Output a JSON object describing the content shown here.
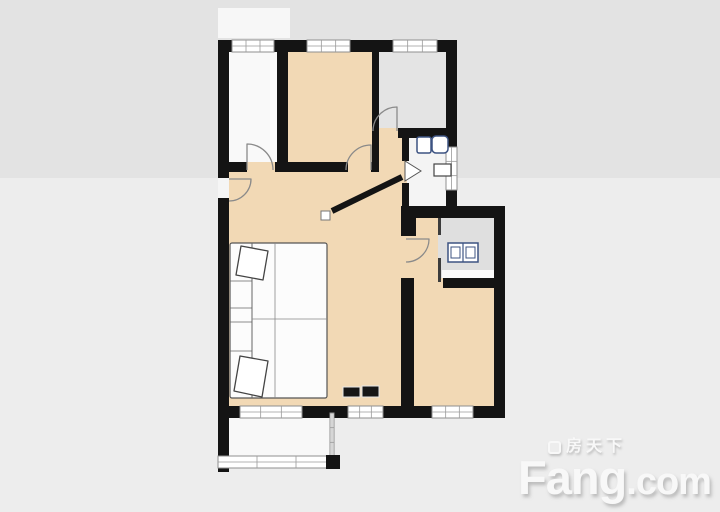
{
  "canvas": {
    "width": 720,
    "height": 512
  },
  "palette": {
    "wall": "#141414",
    "room_warm": "#f2d9b5",
    "room_gray": "#e2e2e2",
    "room_white": "#f8f8f8",
    "window_frame": "#8f8f8f",
    "fixture_outline": "#3d5382",
    "background_upper": "#e3e3e3",
    "background_lower": "#ededed",
    "logo_color": "#f8f8f8"
  },
  "logo": {
    "brand_cn": "房天下",
    "brand_en_main": "Fang",
    "brand_en_suffix": ".com"
  },
  "floorplan": {
    "shapes": [
      {
        "name": "background-upper",
        "kind": "rect",
        "x": 0,
        "y": 0,
        "w": 720,
        "h": 178,
        "fill": "#e3e3e3"
      },
      {
        "name": "background-lower",
        "kind": "rect",
        "x": 0,
        "y": 178,
        "w": 720,
        "h": 334,
        "fill": "#ededed"
      },
      {
        "name": "background-highlight-patch",
        "kind": "rect",
        "x": 218,
        "y": 8,
        "w": 72,
        "h": 30,
        "fill": "#f7f7f7"
      },
      {
        "name": "room-bedroom-left",
        "kind": "rect",
        "x": 222,
        "y": 44,
        "w": 62,
        "h": 126,
        "fill": "#f9f9f9"
      },
      {
        "name": "room-bedroom-middle",
        "kind": "rect",
        "x": 282,
        "y": 44,
        "w": 96,
        "h": 126,
        "fill": "#f2d9b5"
      },
      {
        "name": "room-bedroom-right",
        "kind": "rect",
        "x": 376,
        "y": 44,
        "w": 76,
        "h": 90,
        "fill": "#e4e4e4"
      },
      {
        "name": "room-bathroom",
        "kind": "rect",
        "x": 405,
        "y": 134,
        "w": 45,
        "h": 78,
        "fill": "#f4f4f4"
      },
      {
        "name": "hall-upper",
        "kind": "rect",
        "x": 377,
        "y": 137,
        "w": 30,
        "h": 70,
        "fill": "#f2d9b5"
      },
      {
        "name": "room-living",
        "kind": "rect",
        "x": 222,
        "y": 166,
        "w": 184,
        "h": 246,
        "fill": "#f2d9b5"
      },
      {
        "name": "hall-lower",
        "kind": "rect",
        "x": 402,
        "y": 212,
        "w": 38,
        "h": 72,
        "fill": "#f2d9b5"
      },
      {
        "name": "room-kitchen",
        "kind": "rect",
        "x": 438,
        "y": 212,
        "w": 58,
        "h": 72,
        "fill": "#dfdfdf"
      },
      {
        "name": "kitchen-counter",
        "kind": "rect",
        "x": 442,
        "y": 270,
        "w": 52,
        "h": 11,
        "fill": "#fafafa"
      },
      {
        "name": "room-bedroom-bottom",
        "kind": "rect",
        "x": 406,
        "y": 284,
        "w": 92,
        "h": 128,
        "fill": "#f2d9b5"
      },
      {
        "name": "room-balcony",
        "kind": "rect",
        "x": 222,
        "y": 412,
        "w": 112,
        "h": 52,
        "fill": "#f8f8f8"
      },
      {
        "name": "doorway-left-bedroom",
        "kind": "rect",
        "x": 247,
        "y": 162,
        "w": 28,
        "h": 10,
        "fill": "#f2d9b5"
      },
      {
        "name": "doorway-middle-bedroom",
        "kind": "rect",
        "x": 348,
        "y": 162,
        "w": 23,
        "h": 10,
        "fill": "#f2d9b5"
      },
      {
        "name": "doorway-right-bedroom",
        "kind": "rect",
        "x": 379,
        "y": 128,
        "w": 19,
        "h": 10,
        "fill": "#f2d9b5"
      },
      {
        "name": "doorway-bottom-bedroom",
        "kind": "rect",
        "x": 411,
        "y": 278,
        "w": 32,
        "h": 10,
        "fill": "#f2d9b5"
      },
      {
        "name": "doorway-entrance",
        "kind": "rect",
        "x": 218,
        "y": 178,
        "w": 11,
        "h": 20,
        "fill": "#f5f5f5"
      },
      {
        "name": "wall-top",
        "kind": "rect",
        "x": 218,
        "y": 40,
        "w": 239,
        "h": 12,
        "fill": "#141414"
      },
      {
        "name": "wall-left-upper",
        "kind": "rect",
        "x": 218,
        "y": 40,
        "w": 11,
        "h": 138,
        "fill": "#141414"
      },
      {
        "name": "wall-left-lower",
        "kind": "rect",
        "x": 218,
        "y": 198,
        "w": 11,
        "h": 274,
        "fill": "#141414"
      },
      {
        "name": "wall-bottom",
        "kind": "rect",
        "x": 218,
        "y": 406,
        "w": 287,
        "h": 12,
        "fill": "#141414"
      },
      {
        "name": "wall-right-upper",
        "kind": "rect",
        "x": 446,
        "y": 40,
        "w": 11,
        "h": 172,
        "fill": "#141414"
      },
      {
        "name": "wall-mid-east",
        "kind": "rect",
        "x": 403,
        "y": 206,
        "w": 102,
        "h": 12,
        "fill": "#141414"
      },
      {
        "name": "wall-right-lower",
        "kind": "rect",
        "x": 494,
        "y": 206,
        "w": 11,
        "h": 212,
        "fill": "#141414"
      },
      {
        "name": "wall-divider-left-middle",
        "kind": "rect",
        "x": 277,
        "y": 40,
        "w": 11,
        "h": 132,
        "fill": "#141414"
      },
      {
        "name": "wall-divider-middle-right",
        "kind": "rect",
        "x": 372,
        "y": 40,
        "w": 7,
        "h": 132,
        "fill": "#141414"
      },
      {
        "name": "wall-leftroom-bottom-west",
        "kind": "rect",
        "x": 224,
        "y": 162,
        "w": 23,
        "h": 10,
        "fill": "#141414"
      },
      {
        "name": "wall-leftroom-bottom-east",
        "kind": "rect",
        "x": 275,
        "y": 162,
        "w": 13,
        "h": 10,
        "fill": "#141414"
      },
      {
        "name": "wall-midroom-bottom",
        "kind": "rect",
        "x": 288,
        "y": 162,
        "w": 60,
        "h": 10,
        "fill": "#141414"
      },
      {
        "name": "wall-midroom-bottom-stub",
        "kind": "rect",
        "x": 371,
        "y": 162,
        "w": 8,
        "h": 10,
        "fill": "#141414"
      },
      {
        "name": "wall-grayroom-bottom",
        "kind": "rect",
        "x": 398,
        "y": 128,
        "w": 59,
        "h": 10,
        "fill": "#141414"
      },
      {
        "name": "wall-bathroom-left-upper",
        "kind": "rect",
        "x": 402,
        "y": 137,
        "w": 7,
        "h": 24,
        "fill": "#141414"
      },
      {
        "name": "wall-bathroom-left-lower",
        "kind": "rect",
        "x": 402,
        "y": 183,
        "w": 7,
        "h": 25,
        "fill": "#141414"
      },
      {
        "name": "wall-bedroom-left-upper",
        "kind": "rect",
        "x": 401,
        "y": 206,
        "w": 15,
        "h": 30,
        "fill": "#141414"
      },
      {
        "name": "wall-bedroom-left-lower",
        "kind": "rect",
        "x": 401,
        "y": 278,
        "w": 13,
        "h": 140,
        "fill": "#141414"
      },
      {
        "name": "wall-bedroom-top-west",
        "kind": "rect",
        "x": 406,
        "y": 278,
        "w": 7,
        "h": 10,
        "fill": "#141414"
      },
      {
        "name": "wall-bedroom-top-east",
        "kind": "rect",
        "x": 443,
        "y": 278,
        "w": 62,
        "h": 10,
        "fill": "#141414"
      },
      {
        "name": "wall-kitchen-partition-upper",
        "kind": "rect",
        "x": 438,
        "y": 218,
        "w": 3,
        "h": 17,
        "fill": "#3c3c3c"
      },
      {
        "name": "wall-kitchen-partition-lower",
        "kind": "rect",
        "x": 438,
        "y": 258,
        "w": 3,
        "h": 24,
        "fill": "#3c3c3c"
      },
      {
        "name": "wall-diagonal",
        "kind": "line",
        "x1": 402,
        "y1": 177,
        "x2": 332,
        "y2": 211,
        "stroke": "#141414",
        "sw": 6
      },
      {
        "name": "wall-diagonal-endcap",
        "kind": "rect",
        "x": 321,
        "y": 211,
        "w": 9,
        "h": 9,
        "fill": "#ffffff",
        "stroke": "#777777",
        "sw": 1
      },
      {
        "name": "window-top-left",
        "kind": "window",
        "x": 232,
        "y": 40,
        "w": 42,
        "h": 12
      },
      {
        "name": "window-top-middle",
        "kind": "window",
        "x": 307,
        "y": 40,
        "w": 43,
        "h": 12
      },
      {
        "name": "window-top-right",
        "kind": "window",
        "x": 393,
        "y": 40,
        "w": 44,
        "h": 12
      },
      {
        "name": "window-bathroom",
        "kind": "window",
        "x": 446,
        "y": 147,
        "w": 11,
        "h": 43,
        "vertical": true
      },
      {
        "name": "window-living-left",
        "kind": "window",
        "x": 240,
        "y": 406,
        "w": 62,
        "h": 12
      },
      {
        "name": "window-living-right",
        "kind": "window",
        "x": 348,
        "y": 406,
        "w": 35,
        "h": 12
      },
      {
        "name": "window-bedroom-bottom",
        "kind": "window",
        "x": 432,
        "y": 406,
        "w": 41,
        "h": 12
      },
      {
        "name": "balcony-side-rail",
        "kind": "window",
        "x": 330,
        "y": 413,
        "w": 4,
        "h": 44,
        "vertical": true
      },
      {
        "name": "balcony-front-rail",
        "kind": "window",
        "x": 218,
        "y": 456,
        "w": 117,
        "h": 12
      },
      {
        "name": "balcony-corner-post",
        "kind": "rect",
        "x": 326,
        "y": 455,
        "w": 14,
        "h": 14,
        "fill": "#141414"
      },
      {
        "name": "door-arc-entrance",
        "kind": "path",
        "d": "M229,179 L251,179 A22,22 0 0 1 229,201",
        "stroke": "#8a8a8a",
        "sw": 1.3
      },
      {
        "name": "door-arc-left-bedroom",
        "kind": "path",
        "d": "M247,170 L247,144 A26,26 0 0 1 273,170",
        "stroke": "#8a8a8a",
        "sw": 1.3
      },
      {
        "name": "door-arc-middle-bedroom",
        "kind": "path",
        "d": "M371,170 L371,145 A25,25 0 0 0 346,170",
        "stroke": "#8a8a8a",
        "sw": 1.3
      },
      {
        "name": "door-arc-right-bedroom",
        "kind": "path",
        "d": "M397,131 L397,107 A24,24 0 0 0 373,131",
        "stroke": "#8a8a8a",
        "sw": 1.3
      },
      {
        "name": "door-arc-kitchen",
        "kind": "path",
        "d": "M406,239 L429,239 A23,23 0 0 1 406,262",
        "stroke": "#8a8a8a",
        "sw": 1.3
      },
      {
        "name": "door-marker-bathroom",
        "kind": "polygon",
        "points": "405,161 405,181 421,171",
        "fill": "#ffffff",
        "stroke": "#555555",
        "sw": 1
      },
      {
        "name": "bathroom-sink-left",
        "kind": "rect",
        "x": 417,
        "y": 137,
        "w": 14,
        "h": 16,
        "rx": 2,
        "fill": "#ffffff",
        "stroke": "#3d5382",
        "sw": 1.5
      },
      {
        "name": "bathroom-sink-right",
        "kind": "rect",
        "x": 432,
        "y": 136,
        "w": 16,
        "h": 17,
        "rx": 4,
        "fill": "#ffffff",
        "stroke": "#3d5382",
        "sw": 1.5
      },
      {
        "name": "bathroom-toilet",
        "kind": "rect",
        "x": 434,
        "y": 164,
        "w": 17,
        "h": 12,
        "fill": "#ffffff",
        "stroke": "#444444",
        "sw": 1.2
      },
      {
        "name": "kitchen-sink-body",
        "kind": "rect",
        "x": 448,
        "y": 243,
        "w": 30,
        "h": 19,
        "fill": "#ffffff",
        "stroke": "#3d5382",
        "sw": 1.5
      },
      {
        "name": "kitchen-sink-divider",
        "kind": "line",
        "x1": 463,
        "y1": 243,
        "x2": 463,
        "y2": 262,
        "stroke": "#3d5382",
        "sw": 1.2
      },
      {
        "name": "kitchen-sink-basin-left",
        "kind": "rect",
        "x": 451,
        "y": 247,
        "w": 9,
        "h": 11,
        "fill": "none",
        "stroke": "#3d5382",
        "sw": 1
      },
      {
        "name": "kitchen-sink-basin-right",
        "kind": "rect",
        "x": 466,
        "y": 247,
        "w": 9,
        "h": 11,
        "fill": "none",
        "stroke": "#3d5382",
        "sw": 1
      },
      {
        "name": "sofa-bed-base",
        "kind": "rect",
        "x": 230,
        "y": 243,
        "w": 97,
        "h": 155,
        "rx": 2,
        "fill": "#fcfcfc",
        "stroke": "#555555",
        "sw": 1.2
      },
      {
        "name": "sofa-bed-armrest-line",
        "kind": "line",
        "x1": 252,
        "y1": 243,
        "x2": 252,
        "y2": 398,
        "stroke": "#666666",
        "sw": 1
      },
      {
        "name": "sofa-bed-vertical-seam",
        "kind": "line",
        "x1": 275,
        "y1": 243,
        "x2": 275,
        "y2": 398,
        "stroke": "#888888",
        "sw": 0.8
      },
      {
        "name": "sofa-bed-horizontal-seam",
        "kind": "line",
        "x1": 252,
        "y1": 319,
        "x2": 327,
        "y2": 319,
        "stroke": "#888888",
        "sw": 0.8
      },
      {
        "name": "sofa-cushion-seam-1",
        "kind": "line",
        "x1": 230,
        "y1": 281,
        "x2": 252,
        "y2": 281,
        "stroke": "#666666",
        "sw": 0.8
      },
      {
        "name": "sofa-cushion-seam-2",
        "kind": "line",
        "x1": 230,
        "y1": 308,
        "x2": 252,
        "y2": 308,
        "stroke": "#666666",
        "sw": 0.8
      },
      {
        "name": "sofa-cushion-seam-3",
        "kind": "line",
        "x1": 230,
        "y1": 322,
        "x2": 252,
        "y2": 322,
        "stroke": "#666666",
        "sw": 0.8
      },
      {
        "name": "sofa-cushion-seam-4",
        "kind": "line",
        "x1": 230,
        "y1": 351,
        "x2": 252,
        "y2": 351,
        "stroke": "#666666",
        "sw": 0.8
      },
      {
        "name": "pillow-top",
        "kind": "path",
        "d": "M241,246 L268,251 L263,280 L236,275 Z",
        "fill": "#ffffff",
        "stroke": "#444444",
        "sw": 1.3
      },
      {
        "name": "pillow-bottom",
        "kind": "path",
        "d": "M240,356 L268,361 L262,397 L234,391 Z",
        "fill": "#ffffff",
        "stroke": "#444444",
        "sw": 1.3
      },
      {
        "name": "tv-console-left",
        "kind": "rect",
        "x": 343,
        "y": 387,
        "w": 17,
        "h": 10,
        "fill": "#161616",
        "stroke": "#e6e6e6",
        "sw": 1
      },
      {
        "name": "tv-console-right",
        "kind": "rect",
        "x": 362,
        "y": 386,
        "w": 17,
        "h": 11,
        "fill": "#161616",
        "stroke": "#e6e6e6",
        "sw": 1
      }
    ]
  }
}
